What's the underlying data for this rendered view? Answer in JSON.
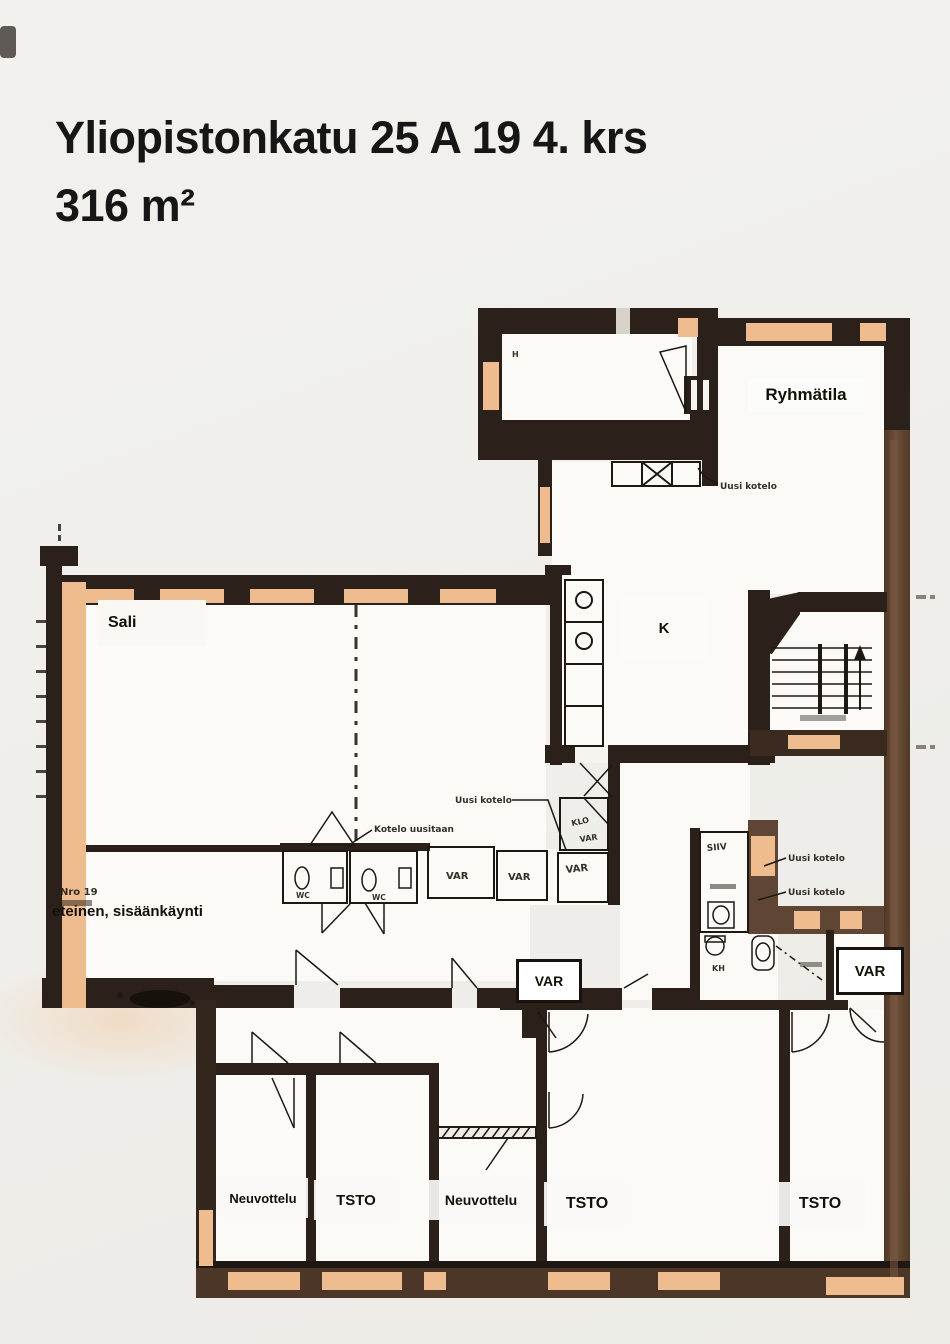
{
  "title": {
    "line1": "Yliopistonkatu 25 A 19 4. krs",
    "line2": "316 m²"
  },
  "rooms": {
    "ryhmatila": "Ryhmätila",
    "sali": "Sali",
    "kitchen": "K",
    "entrance": "eteinen, sisäänkäynti",
    "var_middle": "VAR",
    "var_right": "VAR",
    "neuvottelu_1": "Neuvottelu",
    "tsto_1": "TSTO",
    "neuvottelu_2": "Neuvottelu",
    "tsto_2": "TSTO",
    "tsto_3": "TSTO"
  },
  "annotations": {
    "unit_number": "Nro 19",
    "uusi_kotelo": "Uusi kotelo",
    "kotelo_uusitaan": "Kotelo uusitaan",
    "var_closet": "VAR",
    "klo": "KLO",
    "wc": "WC",
    "siiv": "SIIV",
    "kh": "KH",
    "h_mark": "H"
  },
  "colors": {
    "wall_dark": "#2b211a",
    "wall_brown": "#5f4634",
    "window_peach": "#eebc8e",
    "floor": "#fbfaf7",
    "ink": "#1d1812"
  }
}
